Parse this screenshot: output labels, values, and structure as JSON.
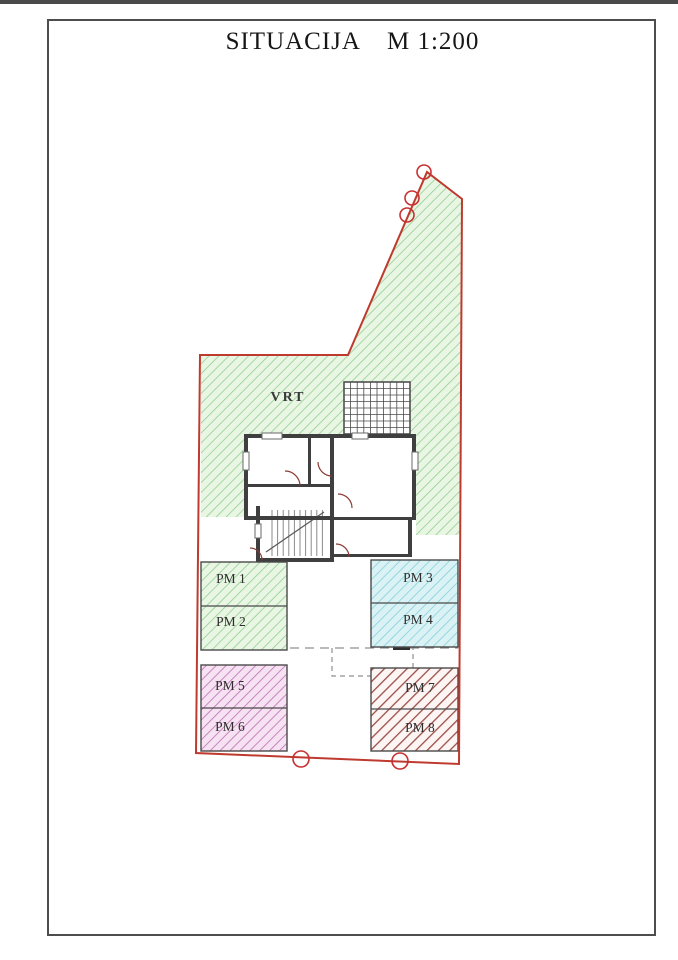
{
  "page": {
    "title": "SITUACIJA",
    "scale": "M 1:200"
  },
  "plan": {
    "garden_label": "VRT",
    "parking": [
      {
        "label": "PM 1"
      },
      {
        "label": "PM 2"
      },
      {
        "label": "PM 3"
      },
      {
        "label": "PM 4"
      },
      {
        "label": "PM 5"
      },
      {
        "label": "PM 6"
      },
      {
        "label": "PM 7"
      },
      {
        "label": "PM 8"
      }
    ],
    "colors": {
      "boundary": "#bf3a2e",
      "marker": "#c93030",
      "garden_bg": "#e9f6e4",
      "garden_line": "#93cf92",
      "cyan_bg": "#dbf2f5",
      "cyan_line": "#83cfdc",
      "magenta_bg": "#f6e2f2",
      "magenta_line": "#bf77b5",
      "darkred_line": "#9a4f48",
      "wall": "#3f3f3f"
    }
  }
}
